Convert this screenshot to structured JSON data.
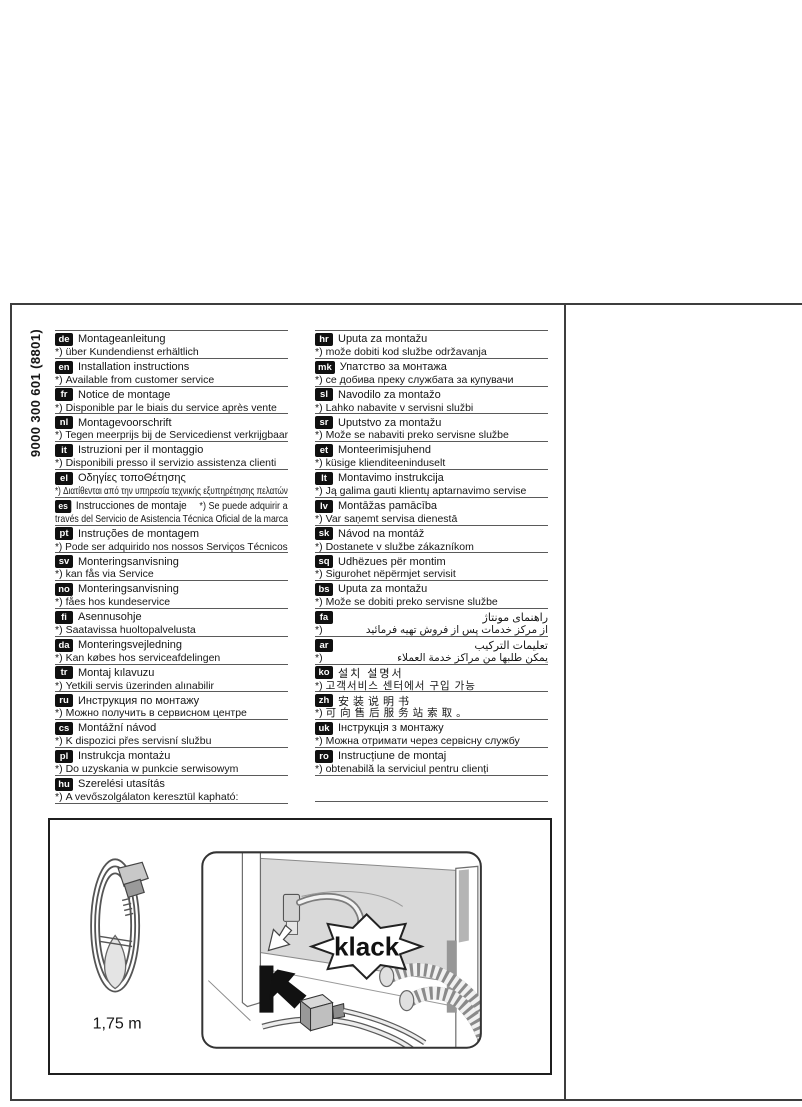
{
  "page": {
    "part_number": "9000 300 601 (8801)"
  },
  "figure": {
    "cable_length_label": "1,75 m",
    "sound_label": "klack"
  },
  "languages": {
    "left": [
      {
        "code": "de",
        "title": "Montageanleitung",
        "note_prefix": "*)",
        "note": "über Kundendienst erhältlich"
      },
      {
        "code": "en",
        "title": "Installation instructions",
        "note_prefix": "*)",
        "note": "Available from customer service"
      },
      {
        "code": "fr",
        "title": "Notice de montage",
        "note_prefix": "*)",
        "note": "Disponible par le biais du service après vente"
      },
      {
        "code": "nl",
        "title": "Montagevoorschrift",
        "note_prefix": "*)",
        "note": "Tegen meerprijs bij de Servicedienst verkrijgbaar"
      },
      {
        "code": "it",
        "title": "Istruzioni per il montaggio",
        "note_prefix": "*)",
        "note": "Disponibili presso il servizio assistenza clienti"
      },
      {
        "code": "el",
        "title": "Οδηγίες τοποΘέτησης",
        "note_prefix": "*)",
        "note": "Διατίθενται από την υπηρεσία τεχνικής εξυπηρέτησης πελατών"
      },
      {
        "code": "es",
        "title": "Instrucciones de montaje",
        "title_suffix": "*) Se puede adquirir a",
        "note": "través del Servicio de Asistencia Técnica Oficial de la marca"
      },
      {
        "code": "pt",
        "title": "Instruções de montagem",
        "note_prefix": "*)",
        "note": "Pode ser adquirido nos nossos Serviços Técnicos"
      },
      {
        "code": "sv",
        "title": "Monteringsanvisning",
        "note_prefix": "*)",
        "note": "kan fås via Service"
      },
      {
        "code": "no",
        "title": "Monteringsanvisning",
        "note_prefix": "*)",
        "note": "fåes hos kundeservice"
      },
      {
        "code": "fi",
        "title": "Asennusohje",
        "note_prefix": "*)",
        "note": "Saatavissa huoltopalvelusta"
      },
      {
        "code": "da",
        "title": "Monteringsvejledning",
        "note_prefix": "*)",
        "note": "Kan købes hos serviceafdelingen"
      },
      {
        "code": "tr",
        "title": "Montaj kılavuzu",
        "note_prefix": "*)",
        "note": "Yetkili servis üzerinden alınabilir"
      },
      {
        "code": "ru",
        "title": "Инструкция по монтажу",
        "note_prefix": "*)",
        "note": "Можно получить в сервисном центре"
      },
      {
        "code": "cs",
        "title": "Montážní návod",
        "note_prefix": "*)",
        "note": "K dispozici přes servisní službu"
      },
      {
        "code": "pl",
        "title": "Instrukcja montażu",
        "note_prefix": "*)",
        "note": "Do uzyskania w punkcie serwisowym"
      },
      {
        "code": "hu",
        "title": "Szerelési utasítás",
        "note_prefix": "*)",
        "note": "A vevőszolgálaton keresztül kapható:"
      }
    ],
    "right": [
      {
        "code": "hr",
        "title": "Uputa za montažu",
        "note_prefix": "*)",
        "note": "može dobiti kod službe održavanja"
      },
      {
        "code": "mk",
        "title": "Упатство за монтажа",
        "note_prefix": "*)",
        "note": "се добива преку службата за купувачи"
      },
      {
        "code": "sl",
        "title": "Navodilo za montažo",
        "note_prefix": "*)",
        "note": "Lahko nabavite v servisni službi"
      },
      {
        "code": "sr",
        "title": "Uputstvo za montažu",
        "note_prefix": "*)",
        "note": "Može se nabaviti preko servisne službe"
      },
      {
        "code": "et",
        "title": "Monteerimisjuhend",
        "note_prefix": "*)",
        "note": "küsige klienditeeninduselt"
      },
      {
        "code": "lt",
        "title": "Montavimo instrukcija",
        "note_prefix": "*)",
        "note": "Ją galima gauti klientų aptarnavimo servise"
      },
      {
        "code": "lv",
        "title": "Montāžas pamācība",
        "note_prefix": "*)",
        "note": "Var saņemt servisa dienestā"
      },
      {
        "code": "sk",
        "title": "Návod na montáž",
        "note_prefix": "*)",
        "note": "Dostanete v službe zákazníkom"
      },
      {
        "code": "sq",
        "title": "Udhëzues për montim",
        "note_prefix": "*)",
        "note": "Sigurohet nëpërmjet servisit"
      },
      {
        "code": "bs",
        "title": "Uputa za montažu",
        "note_prefix": "*)",
        "note": "Može se dobiti preko servisne službe"
      },
      {
        "code": "fa",
        "title": "راهنمای مونتاژ",
        "note_prefix": "*)",
        "note": "از مرکز خدمات پس از فروش تهیه فرمائید",
        "rtl": true
      },
      {
        "code": "ar",
        "title": "تعليمات التركيب",
        "note_prefix": "*)",
        "note": "يمكن طلبها من مراكز خدمة العملاء",
        "rtl": true
      },
      {
        "code": "ko",
        "title": "설치 설명서",
        "note_prefix": "*)",
        "note": "고객서비스 센터에서 구입 가능"
      },
      {
        "code": "zh",
        "title": "安装说明书",
        "note_prefix": "*)",
        "note": "可向售后服务站索取。"
      },
      {
        "code": "uk",
        "title": "Інструкція з монтажу",
        "note_prefix": "*)",
        "note": "Можна отримати через сервісну службу"
      },
      {
        "code": "ro",
        "title": "Instrucțiune de montaj",
        "note_prefix": "*)",
        "note": "obtenabilă la serviciul pentru clienți"
      }
    ]
  }
}
